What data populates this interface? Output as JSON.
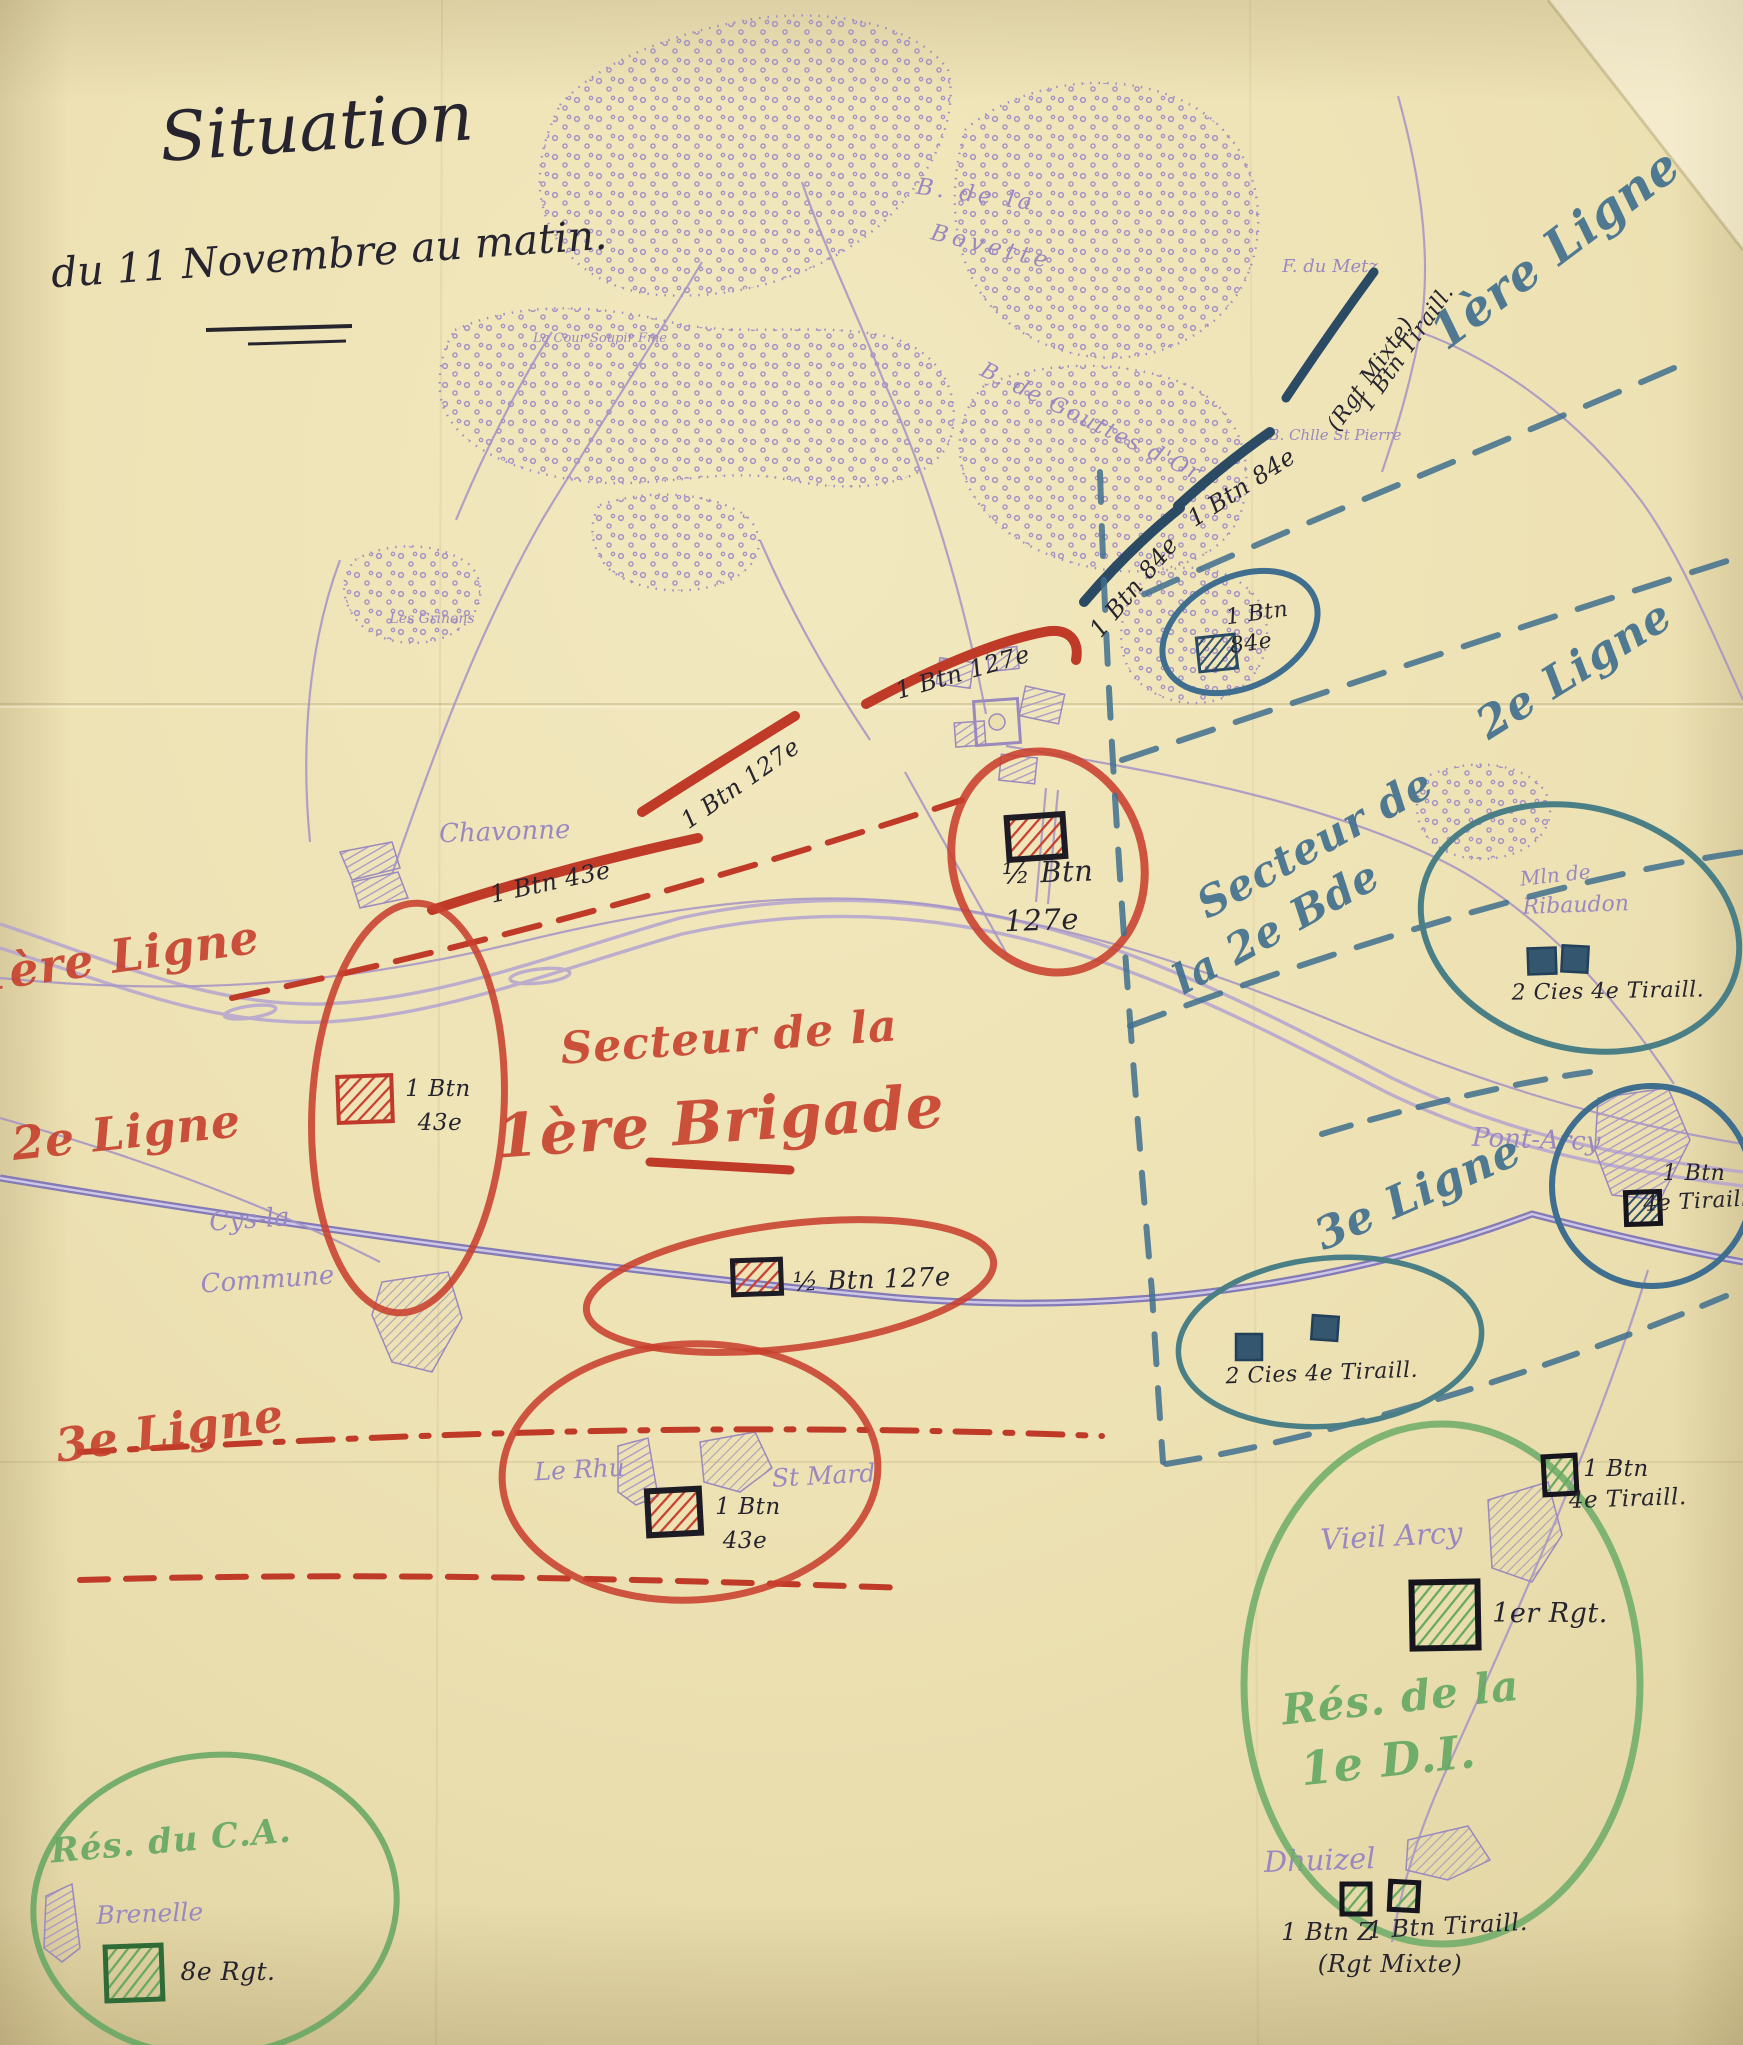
{
  "title": {
    "main": "Situation",
    "date": "du 11 Novembre au matin."
  },
  "colors": {
    "paper": "#ece0b0",
    "red": "#c6402d",
    "blue": "#3f6e8e",
    "teal": "#47808b",
    "navy": "#2a4b63",
    "green": "#64a763",
    "purple": "#9a88c0",
    "ink": "#26242e"
  },
  "red_labels": {
    "ligne1": "1ère Ligne",
    "ligne2": "2e Ligne",
    "ligne3": "3e Ligne",
    "secteur_line1": "Secteur de la",
    "secteur_line2": "1ère Brigade"
  },
  "blue_labels": {
    "ligne1": "1ère Ligne",
    "ligne2": "2e Ligne",
    "ligne3": "3e Ligne",
    "secteur_line1": "Secteur de",
    "secteur_line2": "la 2e Bde"
  },
  "green_labels": {
    "res_di_line1": "Rés. de la",
    "res_di_line2": "1e D.I.",
    "res_ca": "Rés. du C.A."
  },
  "units": {
    "btn_tiraill_line1": "1 Btn Tiraill.",
    "btn_tiraill_line2": "(Rgt Mixte)",
    "btn84_arc1": "1 Btn 84e",
    "btn84_arc2": "1 Btn 84e",
    "btn84_oval_line1": "1 Btn",
    "btn84_oval_line2": "84e",
    "btn127_arc1": "1 Btn 127e",
    "btn127_arc2": "1 Btn 127e",
    "btn43_chavonne": "1 Btn 43e",
    "half_btn127_line1": "½ Btn",
    "half_btn127_line2": "127e",
    "btn43_oval_line1": "1 Btn",
    "btn43_oval_line2": "43e",
    "half_btn127_rail": "½ Btn 127e",
    "cies_tiraill_ribaudon": "2 Cies 4e Tiraill.",
    "btn_tiraill_pontarcy_line1": "1 Btn",
    "btn_tiraill_pontarcy_line2": "4e Tiraill.",
    "cies_tiraill_south": "2 Cies 4e Tiraill.",
    "btn43_rhu_line1": "1 Btn",
    "btn43_rhu_line2": "43e",
    "btn_tiraill_green_line1": "1 Btn",
    "btn_tiraill_green_line2": "4e Tiraill.",
    "rgt1": "1er Rgt.",
    "btn_z": "1 Btn Z",
    "btn_tiraill_dhuizel": "1 Btn Tiraill.",
    "rgt_mixte_dhuizel": "(Rgt Mixte)",
    "rgt8": "8e Rgt."
  },
  "places": {
    "chavonne": "Chavonne",
    "cour_soupir": "La Cour Soupir Fme",
    "grinons": "Les Grinons",
    "bovette_line1": "B. de la",
    "bovette_line2": "Bovette",
    "gouttes_dor": "B. de Gouttes d'Or",
    "f_du_metz": "F. du Metz",
    "chapelle": "B. Chlle St Pierre",
    "cys_line1": "Cys-la",
    "cys_line2": "Commune",
    "pont_arcy": "Pont-Arcy",
    "ribaudon_line1": "Mln de",
    "ribaudon_line2": "Ribaudon",
    "vieil_arcy": "Vieil Arcy",
    "le_rhu": "Le Rhu",
    "st_mard": "St Mard",
    "dhuizel": "Dhuizel",
    "brenelle": "Brenelle"
  }
}
